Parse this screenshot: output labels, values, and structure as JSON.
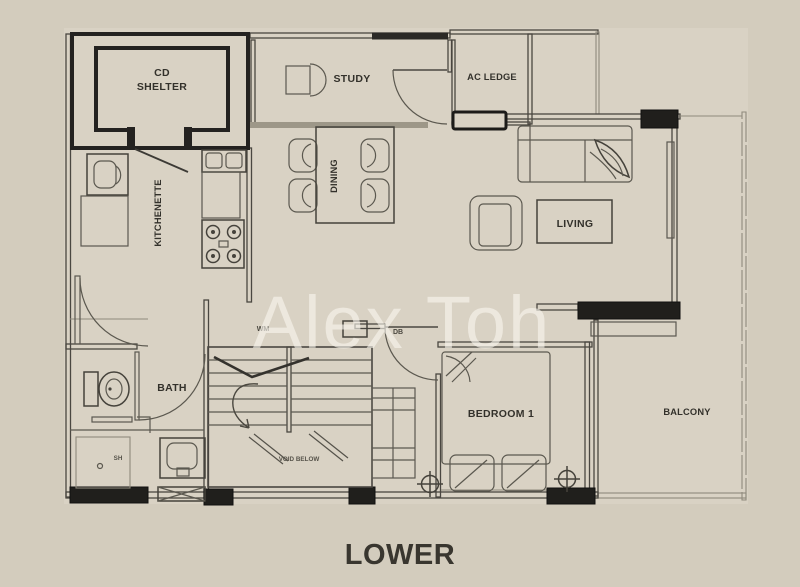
{
  "watermark": "Alex Toh",
  "floor_label": "LOWER",
  "rooms": {
    "cd_shelter": [
      "CD",
      "SHELTER"
    ],
    "study": "STUDY",
    "ac_ledge": "AC LEDGE",
    "dining": "DINING",
    "kitchenette": "KITCHENETTE",
    "living": "LIVING",
    "bath": "BATH",
    "bedroom_1": "BEDROOM 1",
    "balcony": "BALCONY"
  },
  "annotations": {
    "void_below": "VOID BELOW",
    "wm_point": "WM",
    "db_point": "DB",
    "shower": "SH"
  },
  "colors": {
    "background": "#d3ccbd",
    "floor": "#d9d2c4",
    "wall": "#4a4741",
    "wall_black": "#201f1c",
    "label_text": "#33312b",
    "watermark_text": "rgba(248,245,237,0.62)"
  }
}
